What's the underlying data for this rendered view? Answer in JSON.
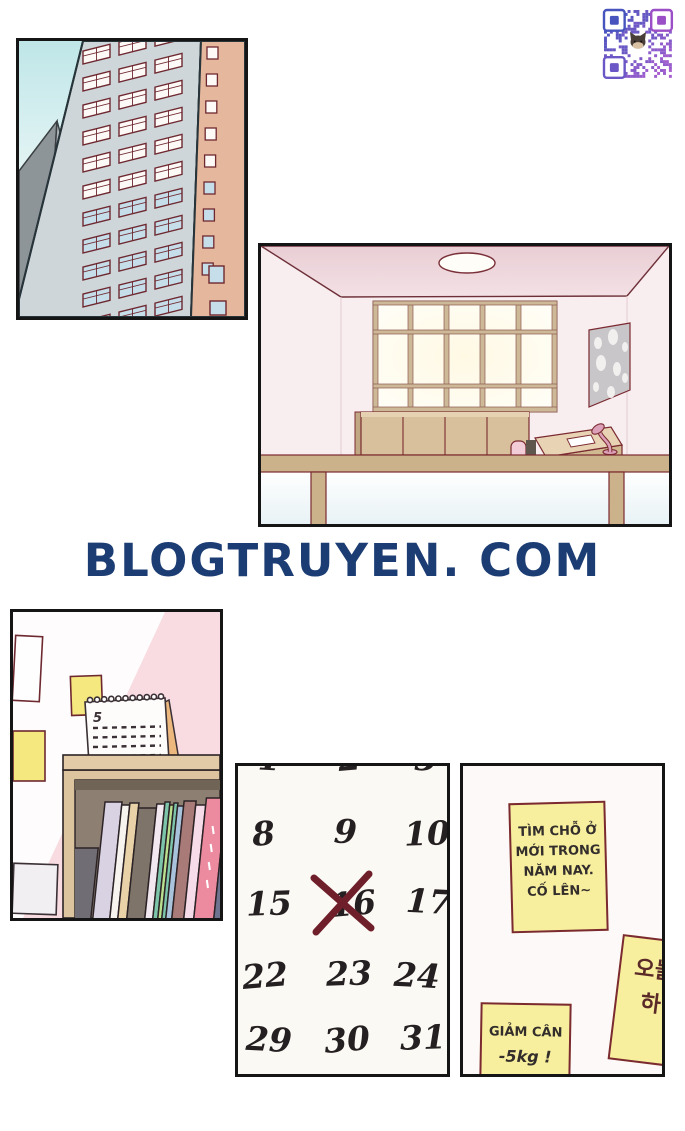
{
  "page": {
    "watermark": {
      "text": "BLOGTRUYEN. COM",
      "color": "#1c3d74"
    }
  },
  "qr": {
    "name": "qr-code",
    "color_blue": "#4754be",
    "color_purple": "#a85fd0",
    "finder_top_left": "#4754be",
    "finder_top_right": "#9b4fc6",
    "finder_bottom_left": "#6c57c6",
    "center_icon": "cat-face"
  },
  "panels": {
    "buildings": {
      "sky_top": "#bfe6e8",
      "sky_bottom": "#f6fbfa",
      "tower_gray_dark": "#8d9599",
      "tower_gray_light": "#abb3b7",
      "tower_main": "#ced6d9",
      "tower_salmon": "#e5b79c",
      "window_frame": "#6e2830",
      "window_white": "#fdf9f6",
      "window_blue": "#c6dee9"
    },
    "room": {
      "wall": "#f8edef",
      "ceiling": "#ecd4d9",
      "window_frame": "#cdb897",
      "cabinet": "#d8c09c",
      "wood": "#cbb28a",
      "accent": "#7a2a30",
      "poster_gray": "#c9c6c9",
      "lamp_pink": "#dca0b8",
      "floor": "#e8f2f5"
    },
    "shelf": {
      "wall_pink": "#f8dce2",
      "note_yellow": "#f5e87e",
      "calendar_month": "5",
      "shelf_wood": "#dcc49e",
      "shelf_back": "#8d8072",
      "book_colors": [
        "#716d74",
        "#d9d2e3",
        "#f7f4ef",
        "#e9d2a8",
        "#7e7469",
        "#f2e8f0",
        "#7cc4aa",
        "#b9e08e",
        "#7cc4aa",
        "#a9c3dc",
        "#a87a78",
        "#f6dce8",
        "#ec8ba0",
        "#6e7490",
        "#5c2430"
      ]
    },
    "calendar": {
      "rows": [
        [
          "1",
          "2",
          "3"
        ],
        [
          "8",
          "9",
          "10"
        ],
        [
          "15",
          "16",
          "17"
        ],
        [
          "22",
          "23",
          "24"
        ],
        [
          "29",
          "30",
          "31"
        ]
      ],
      "crossed_value": "16",
      "ink": "#241f20",
      "cross_color": "#6e1f2a",
      "background": "#fbf9f4"
    },
    "notes": {
      "background": "#fdf9f9",
      "sticky_yellow": "#f7ef9d",
      "ink": "#332e2c",
      "note1_lines": [
        "TÌM CHỖ Ở",
        "MỚI TRONG",
        "NĂM NAY.",
        "CỐ LÊN~"
      ],
      "note2_lines": [
        "오늘",
        "하"
      ],
      "note3_line1": "GIẢM CÂN",
      "note3_line2": "-5kg !"
    }
  }
}
